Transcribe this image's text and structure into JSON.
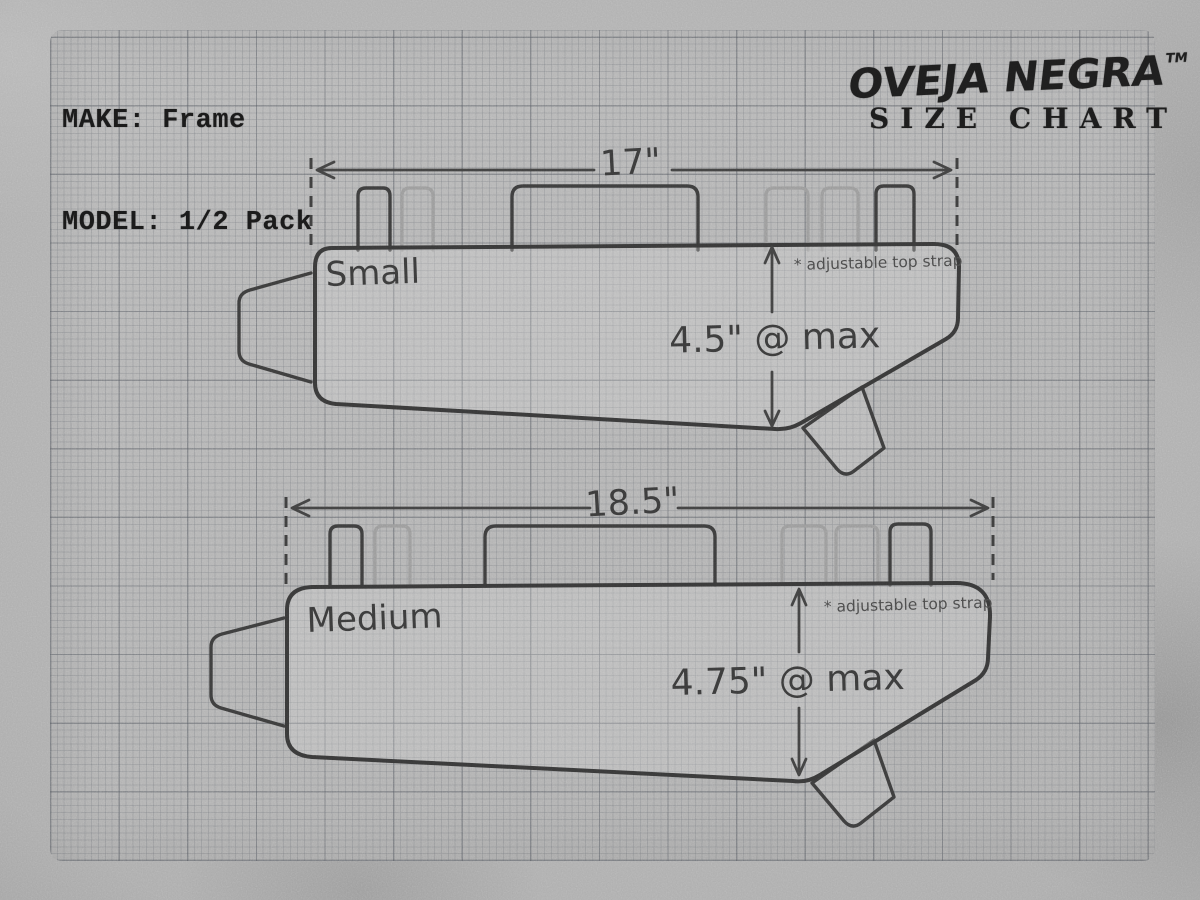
{
  "header": {
    "make_line": "MAKE: Frame",
    "model_line": "MODEL: 1/2 Pack"
  },
  "brand": {
    "name": "OVEJA NEGRA",
    "trademark": "TM",
    "tagline": "SIZE CHART"
  },
  "diagrams": [
    {
      "size_label": "Small",
      "width_label": "17\"",
      "height_label": "4.5\" @ max",
      "note": "* adjustable top strap",
      "width_in": 17,
      "max_height_in": 4.5
    },
    {
      "size_label": "Medium",
      "width_label": "18.5\"",
      "height_label": "4.75\" @ max",
      "note": "* adjustable top strap",
      "width_in": 18.5,
      "max_height_in": 4.75
    }
  ],
  "colors": {
    "ink": "#383838",
    "light_ink": "#9a9a9a",
    "paper": "#b4b4b4",
    "background": "#a4a4a4"
  }
}
